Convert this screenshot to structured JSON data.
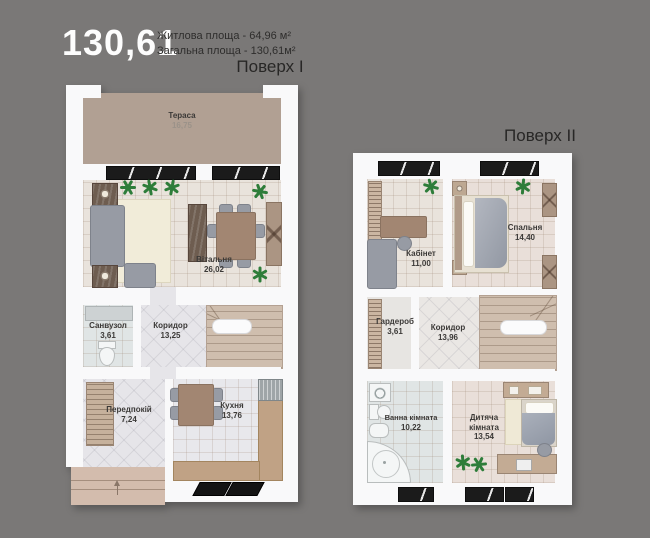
{
  "header": {
    "big_number": "130,61",
    "line1": "Житлова площа - 64,96 м²",
    "line2": "Загальна площа - 130,61м²",
    "floor1_title": "Поверх I",
    "floor2_title": "Поверх II"
  },
  "floor1": {
    "rooms": [
      {
        "name": "Тераса",
        "area": "16,75"
      },
      {
        "name": "Вітальня",
        "area": "26,02"
      },
      {
        "name": "Санвузол",
        "area": "3,61"
      },
      {
        "name": "Коридор",
        "area": "13,25"
      },
      {
        "name": "Передпокій",
        "area": "7,24"
      },
      {
        "name": "Кухня",
        "area": "13,76"
      }
    ]
  },
  "floor2": {
    "rooms": [
      {
        "name": "Кабінет",
        "area": "11,00"
      },
      {
        "name": "Спальня",
        "area": "14,40"
      },
      {
        "name": "Гардероб",
        "area": "3,61"
      },
      {
        "name": "Коридор",
        "area": "13,96"
      },
      {
        "name": "Ванна кімната",
        "area": "10,22"
      },
      {
        "name": "Дитяча кімната",
        "area": "13,54"
      }
    ]
  },
  "palette": {
    "background": "#7a7877",
    "wall_white": "#f9f9fa",
    "terrace_floor": "#b1a093",
    "living_floor": "#e9e3dc",
    "corridor_floor": "#e6e5e9",
    "bathroom_floor": "#e0e5e5",
    "kitchen_counter": "#c0a285",
    "stairs": "#cfbeae",
    "furniture_gray": "#979ba4",
    "plant_green": "#2e7d3a",
    "window_black": "#1b1b1b",
    "porch": "#d3bcad",
    "label_text": "#3b3937"
  },
  "icons": {
    "plant": "six-spoke-star",
    "entry_arrow": "up-arrow"
  }
}
